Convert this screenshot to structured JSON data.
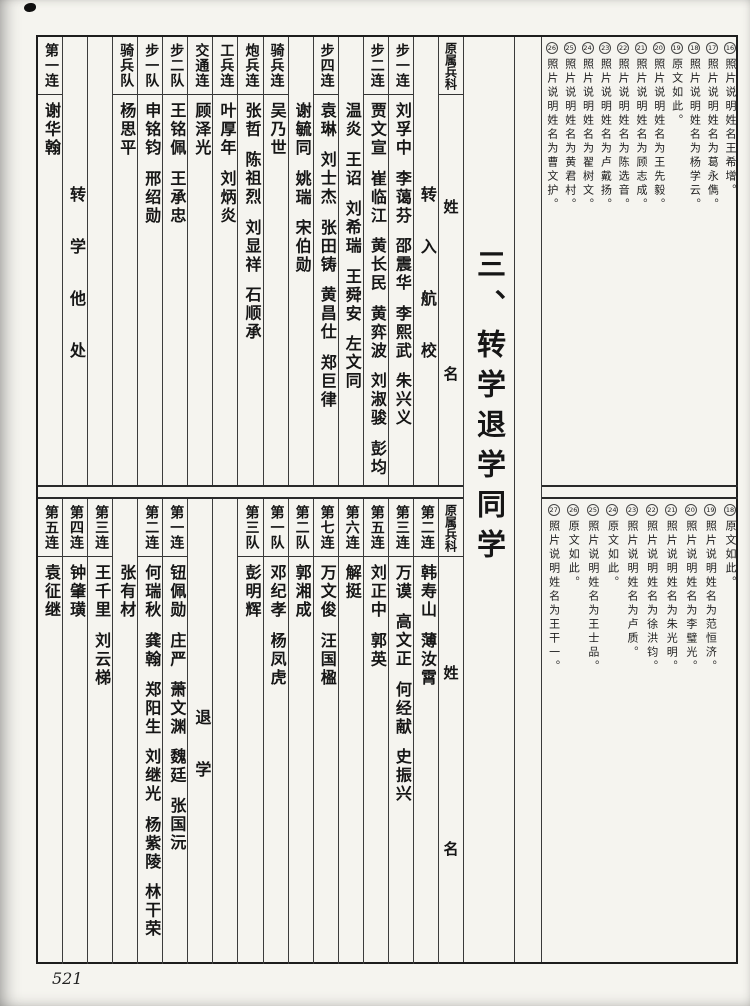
{
  "page": {
    "number": "521",
    "title": "三、转学退学同学"
  },
  "top_table": {
    "header": {
      "branch": "原属兵科",
      "name_top": "姓",
      "name_bottom": "名"
    },
    "columns": [
      {
        "company": "",
        "label": "转入航校"
      },
      {
        "company": "步一连",
        "names": [
          "刘孚中",
          "李蔼芬",
          "邵震华",
          "李熙武",
          "朱兴义",
          "郭岳生"
        ]
      },
      {
        "company": "步二连",
        "names": [
          "贾文宣",
          "崔临江",
          "黄长民",
          "黄弈波",
          "刘淑骏",
          "彭均"
        ]
      },
      {
        "company": "",
        "names": [
          "温炎",
          "王诏",
          "刘希瑞",
          "王舜安",
          "左文同"
        ]
      },
      {
        "company": "步四连",
        "names": [
          "袁琳",
          "刘士杰",
          "张田铸",
          "黄昌仕",
          "郑巨律"
        ]
      },
      {
        "company": "",
        "names": [
          "谢毓同",
          "姚瑞",
          "宋伯勋"
        ]
      },
      {
        "company": "骑兵连",
        "names": [
          "吴乃世"
        ]
      },
      {
        "company": "炮兵连",
        "names": [
          "张哲",
          "陈祖烈",
          "刘显祥",
          "石顺承"
        ]
      },
      {
        "company": "工兵连",
        "names": [
          "叶厚年",
          "刘炳炎"
        ]
      },
      {
        "company": "交通连",
        "names": [
          "顾泽光"
        ]
      },
      {
        "company": "步二队",
        "names": [
          "王铭佩",
          "王承忠"
        ]
      },
      {
        "company": "步一队",
        "names": [
          "申铭钧",
          "邢绍勋"
        ]
      },
      {
        "company": "骑兵队",
        "names": [
          "杨思平"
        ]
      },
      {
        "company": "",
        "names": []
      },
      {
        "company": "",
        "label": "转学他处"
      },
      {
        "company": "第一连",
        "names": [
          "谢华翰"
        ]
      }
    ]
  },
  "bottom_table": {
    "header": {
      "branch": "原属兵科",
      "name_top": "姓",
      "name_bottom": "名"
    },
    "columns": [
      {
        "company": "第二连",
        "names": [
          "韩寿山",
          "薄汝霄"
        ]
      },
      {
        "company": "第三连",
        "names": [
          "万谟",
          "高文正",
          "何经献",
          "史振兴"
        ]
      },
      {
        "company": "第五连",
        "names": [
          "刘正中",
          "郭英"
        ]
      },
      {
        "company": "第六连",
        "names": [
          "解挺"
        ]
      },
      {
        "company": "第七连",
        "names": [
          "万文俊",
          "汪国楹"
        ]
      },
      {
        "company": "第二队",
        "names": [
          "郭湘成"
        ]
      },
      {
        "company": "第一队",
        "names": [
          "邓纪孝",
          "杨凤虎"
        ]
      },
      {
        "company": "第三队",
        "names": [
          "彭明辉"
        ]
      },
      {
        "company": "",
        "names": []
      },
      {
        "company": "",
        "label": "退学"
      },
      {
        "company": "第一连",
        "names": [
          "钮佩勋",
          "庄严",
          "萧文渊",
          "魏廷",
          "张国沅"
        ]
      },
      {
        "company": "第二连",
        "names": [
          "何瑞秋",
          "龚翰",
          "郑阳生",
          "刘继光",
          "杨紫陵",
          "林干荣"
        ]
      },
      {
        "company": "",
        "names": [
          "张有材"
        ]
      },
      {
        "company": "第三连",
        "names": [
          "王千里",
          "刘云梯"
        ]
      },
      {
        "company": "第四连",
        "names": [
          "钟肇璜"
        ]
      },
      {
        "company": "第五连",
        "names": [
          "袁征继"
        ]
      }
    ]
  },
  "annotations": {
    "top": [
      {
        "num": "16",
        "text": "照片说明姓名王希增。"
      },
      {
        "num": "17",
        "text": "照片说明姓名为葛永儁。"
      },
      {
        "num": "18",
        "text": "照片说明姓名为杨学云。"
      },
      {
        "num": "19",
        "text": "原文如此。"
      },
      {
        "num": "20",
        "text": "照片说明姓名为王先毅。"
      },
      {
        "num": "21",
        "text": "照片说明姓名为顾志成。"
      },
      {
        "num": "22",
        "text": "照片说明姓名为陈选音。"
      },
      {
        "num": "23",
        "text": "照片说明姓名为卢戴扬。"
      },
      {
        "num": "24",
        "text": "照片说明姓名为翟树文。"
      },
      {
        "num": "25",
        "text": "照片说明姓名为黄君村。"
      },
      {
        "num": "26",
        "text": "照片说明姓名为曹文护。"
      }
    ],
    "bottom": [
      {
        "num": "18",
        "text": "原文如此。"
      },
      {
        "num": "19",
        "text": "照片说明姓名为范恒济。"
      },
      {
        "num": "20",
        "text": "照片说明姓名为李璧光。"
      },
      {
        "num": "21",
        "text": "照片说明姓名为朱光明。"
      },
      {
        "num": "22",
        "text": "照片说明姓名为徐洪钧。"
      },
      {
        "num": "23",
        "text": "照片说明姓名为卢质。"
      },
      {
        "num": "24",
        "text": "原文如此。"
      },
      {
        "num": "25",
        "text": "照片说明姓名为王士品。"
      },
      {
        "num": "26",
        "text": "原文如此。"
      },
      {
        "num": "27",
        "text": "照片说明姓名为王干一。"
      }
    ]
  }
}
